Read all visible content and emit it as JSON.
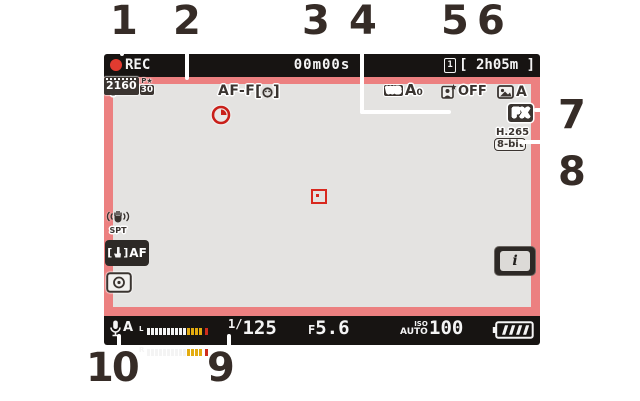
{
  "colors": {
    "frame_red": "#ec8080",
    "lcd_gray": "#e4e3e1",
    "bar_black": "#171412",
    "callout": "#362c27",
    "rec_red": "#e23b30",
    "focus_red": "#d8281e",
    "glyph_dark": "#3a3430",
    "meter_yellow": "#e3ac10",
    "meter_red": "#cf2d1d"
  },
  "callouts": [
    {
      "n": "1"
    },
    {
      "n": "2"
    },
    {
      "n": "3"
    },
    {
      "n": "4"
    },
    {
      "n": "5"
    },
    {
      "n": "6"
    },
    {
      "n": "7"
    },
    {
      "n": "8"
    },
    {
      "n": "9"
    },
    {
      "n": "10"
    }
  ],
  "top_bar": {
    "rec_label": "REC",
    "timecode": "00m00s",
    "card_slot_number": "1",
    "time_remaining": "[ 2h05m ]"
  },
  "lcd": {
    "exposure_mode": "P",
    "focus_mode": "AF-F",
    "subject_bracket_left": "[",
    "subject_bracket_right": "]",
    "wb_label": "WB",
    "wb_value": "A",
    "wb_sub": "0",
    "portrait_balance_value": "OFF",
    "picture_control_value": "A",
    "frame_size": "2160",
    "frame_quality": "P★",
    "frame_rate": "30",
    "image_area": "FX",
    "codec": "H.265",
    "bit_depth": "8-bit",
    "vr_mode": "SPT",
    "touch_af_bracket_left": "[",
    "touch_af_bracket_right": "]",
    "touch_af_label": "AF",
    "i_button_label": "i"
  },
  "bottom_bar": {
    "mic_mode": "A",
    "meter": {
      "left_label": "L",
      "right_label": "R",
      "white_bars": 10,
      "yellow_bars": 4,
      "red_bars": 1
    },
    "shutter_prefix": "1/",
    "shutter_value": "125",
    "aperture_prefix": "F",
    "aperture_value": "5.6",
    "iso_label": "ISO",
    "iso_mode": "AUTO",
    "iso_value": "100"
  }
}
